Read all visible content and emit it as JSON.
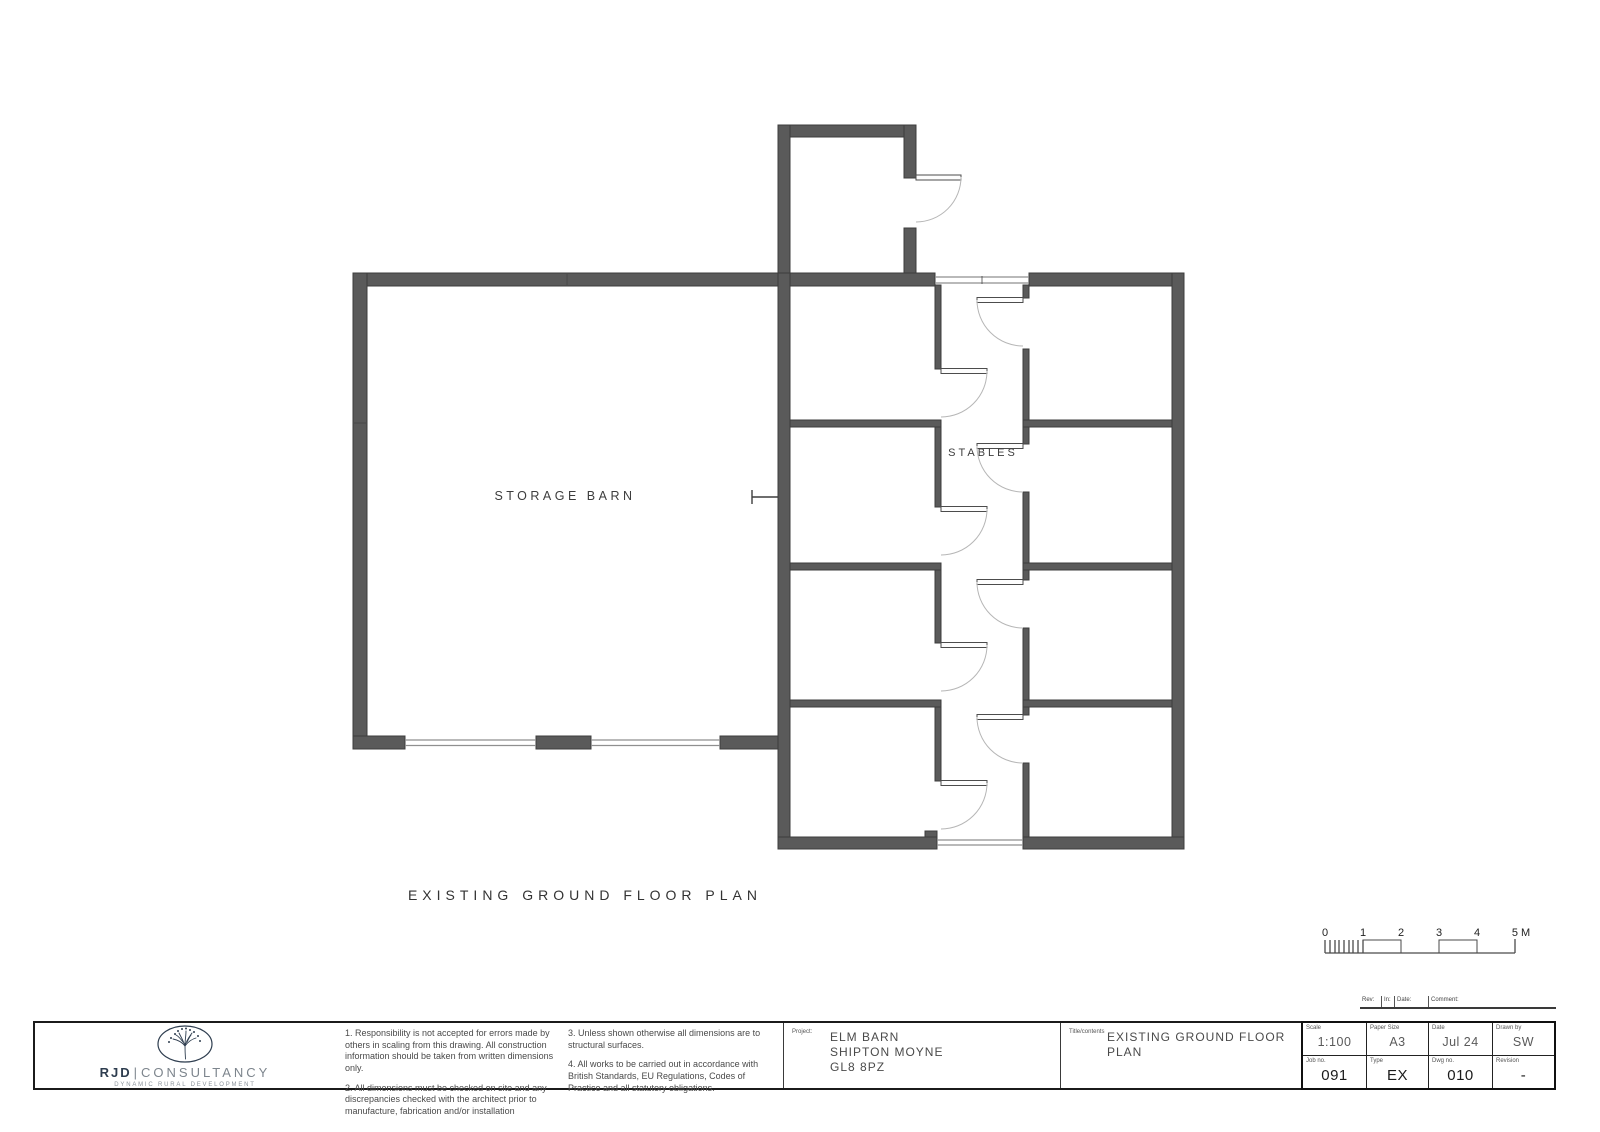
{
  "drawing": {
    "storage_barn_label": "STORAGE BARN",
    "stables_label": "STABLES",
    "caption": "EXISTING GROUND FLOOR PLAN"
  },
  "scale_bar": {
    "labels": [
      "0",
      "1",
      "2",
      "3",
      "4",
      "5 M"
    ]
  },
  "revision_strip": {
    "labels": [
      "Rev:",
      "In:",
      "Date:",
      "Comment:"
    ]
  },
  "title_block": {
    "brand": {
      "name_bold": "RJD",
      "separator": "|",
      "name_rest": "CONSULTANCY",
      "tagline": "DYNAMIC RURAL DEVELOPMENT"
    },
    "notes": [
      "1. Responsibility is not accepted for errors made by others in scaling from this drawing. All construction information should be taken from written dimensions only.",
      "2. All dimensions must be checked on site and any discrepancies checked with the architect prior to manufacture, fabrication and/or installation",
      "3. Unless shown otherwise all dimensions are to structural surfaces.",
      "4. All works to be carried out in accordance with British Standards, EU Regulations, Codes of Practice and all statutory obligations."
    ],
    "project": {
      "label": "Project:",
      "lines": [
        "ELM BARN",
        "SHIPTON MOYNE",
        "GL8 8PZ"
      ]
    },
    "sheet_title": {
      "label": "Title/contents",
      "lines": [
        "EXISTING GROUND FLOOR",
        "PLAN"
      ]
    },
    "fields": [
      {
        "label": "Scale",
        "value": "1:100"
      },
      {
        "label": "Paper Size",
        "value": "A3"
      },
      {
        "label": "Date",
        "value": "Jul 24"
      },
      {
        "label": "Drawn by",
        "value": "SW"
      },
      {
        "label": "Job no.",
        "value": "091"
      },
      {
        "label": "Type",
        "value": "EX"
      },
      {
        "label": "Dwg no.",
        "value": "010"
      },
      {
        "label": "Revision",
        "value": "-"
      }
    ]
  },
  "colors": {
    "wall": "#5a5a5a",
    "wall_edge": "#3c3c3c",
    "door_arc": "#b6b6b6",
    "label_text": "#3d3d3d",
    "brand_navy": "#2e3d4f"
  }
}
